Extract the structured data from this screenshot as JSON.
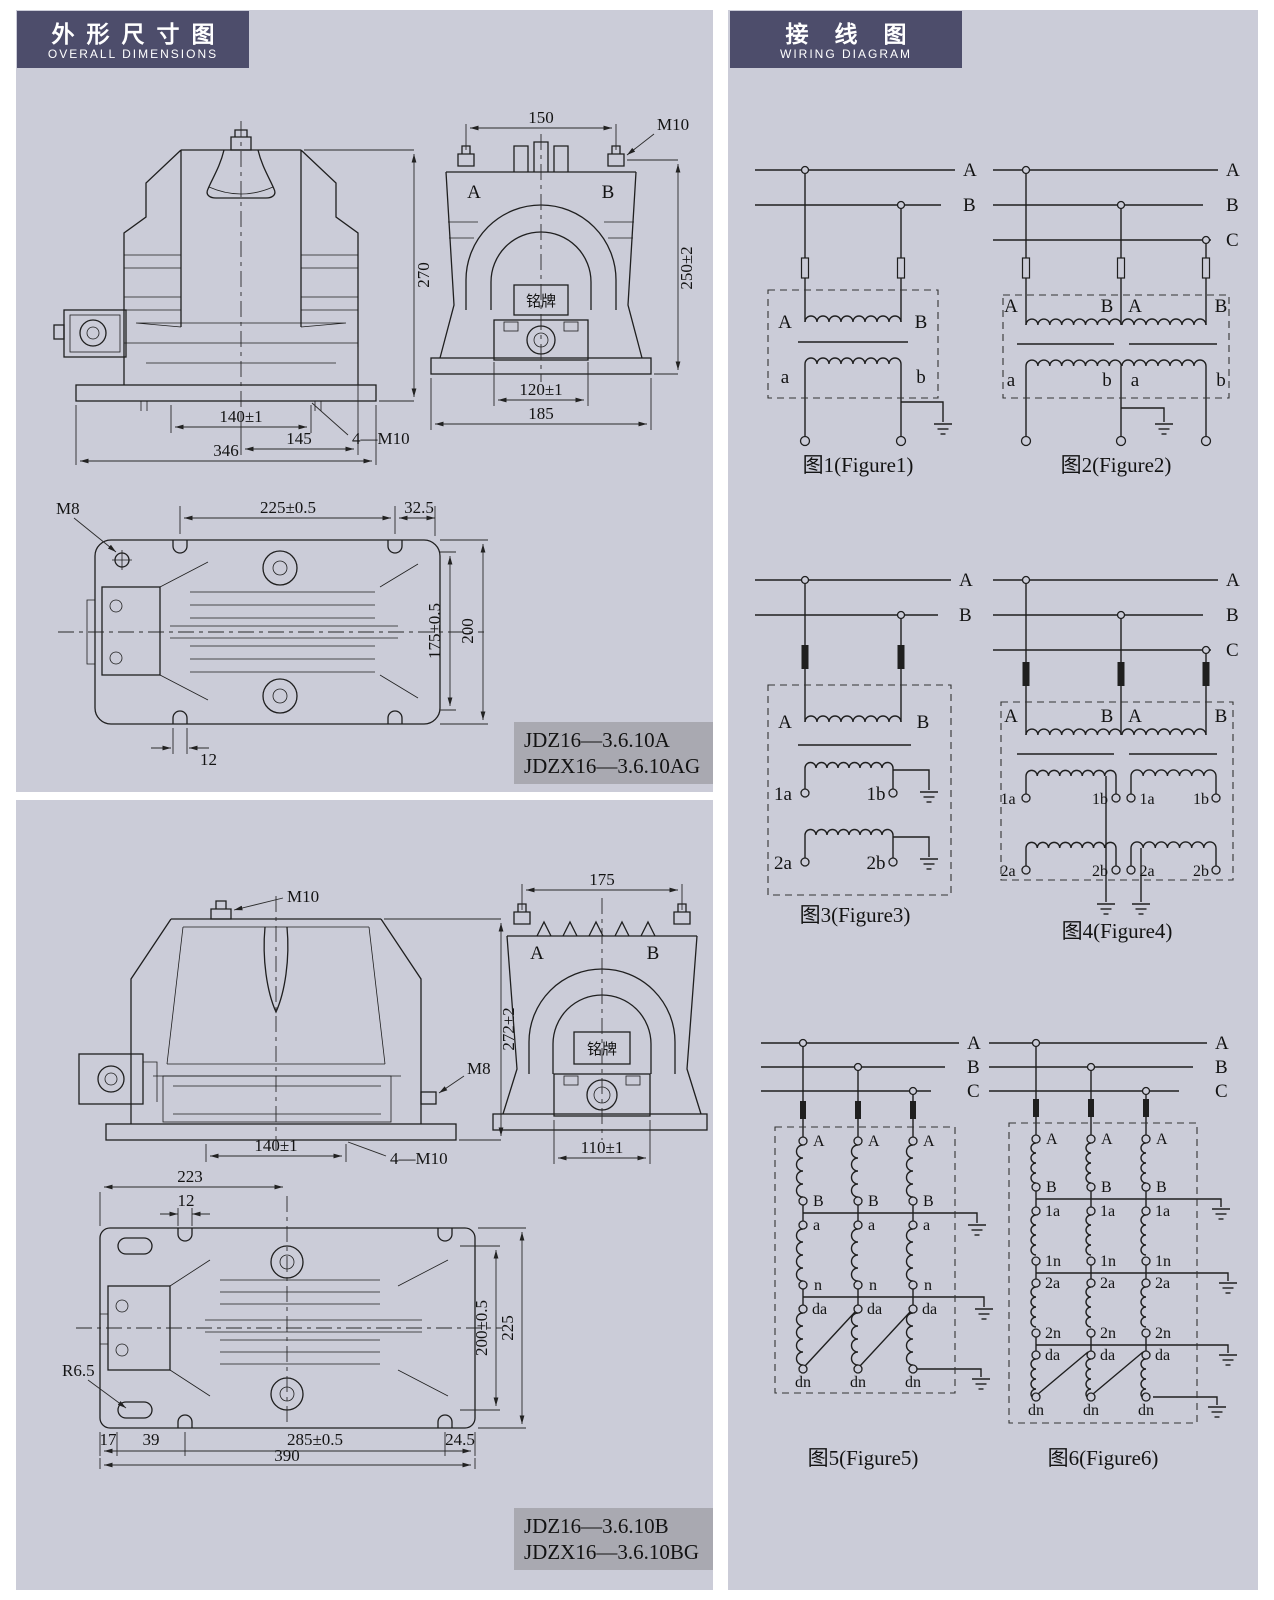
{
  "colors": {
    "panel_bg": "#cbccd8",
    "header_bg": "#4d4d6b",
    "model_box_bg": "#a9a9b1",
    "line": "#1f1f1f"
  },
  "headers": {
    "left": {
      "zh": "外形尺寸图",
      "en": "OVERALL DIMENSIONS"
    },
    "right": {
      "zh": "接线图",
      "en": "WIRING DIAGRAM"
    }
  },
  "models": {
    "a": {
      "line1": "JDZ16—3.6.10A",
      "line2": "JDZX16—3.6.10AG"
    },
    "b": {
      "line1": "JDZ16—3.6.10B",
      "line2": "JDZX16—3.6.10BG"
    }
  },
  "d": {
    "af": {
      "h270": "270",
      "w140": "140±1",
      "m10": "4—M10",
      "w145": "145",
      "w346": "346"
    },
    "as": {
      "w150": "150",
      "m10": "M10",
      "a": "A",
      "b": "B",
      "np": "铭牌",
      "h250": "250±2",
      "w120": "120±1",
      "w185": "185"
    },
    "at": {
      "m8": "M8",
      "w225": "225±0.5",
      "w325": "32.5",
      "h175": "175±0.5",
      "h200": "200",
      "w12": "12"
    },
    "bf": {
      "m10": "M10",
      "h272": "272±2",
      "m8": "M8",
      "w140": "140±1",
      "m104": "4—M10"
    },
    "bs": {
      "w175": "175",
      "a": "A",
      "b": "B",
      "np": "铭牌",
      "w110": "110±1"
    },
    "bt": {
      "w223": "223",
      "w12": "12",
      "r65": "R6.5",
      "d17": "17",
      "d39": "39",
      "d285": "285±0.5",
      "d245": "24.5",
      "d390": "390",
      "h200": "200±0.5",
      "h225": "225"
    }
  },
  "figs": {
    "f1": {
      "cap": "图1(Figure1)",
      "bus": [
        "A",
        "B"
      ],
      "p": [
        "A",
        "B"
      ],
      "s": [
        "a",
        "b"
      ]
    },
    "f2": {
      "cap": "图2(Figure2)",
      "bus": [
        "A",
        "B",
        "C"
      ],
      "p": [
        "A",
        "B"
      ],
      "s": [
        "a",
        "b"
      ]
    },
    "f3": {
      "cap": "图3(Figure3)",
      "bus": [
        "A",
        "B"
      ],
      "p": [
        "A",
        "B"
      ],
      "s1": [
        "1a",
        "1b"
      ],
      "s2": [
        "2a",
        "2b"
      ]
    },
    "f4": {
      "cap": "图4(Figure4)",
      "bus": [
        "A",
        "B",
        "C"
      ],
      "p": [
        "A",
        "B"
      ],
      "s1": [
        "1a",
        "1b"
      ],
      "s2": [
        "2a",
        "2b"
      ]
    },
    "f5": {
      "cap": "图5(Figure5)",
      "bus": [
        "A",
        "B",
        "C"
      ],
      "w": [
        "A",
        "B",
        "a",
        "n",
        "da",
        "dn"
      ]
    },
    "f6": {
      "cap": "图6(Figure6)",
      "bus": [
        "A",
        "B",
        "C"
      ],
      "w": [
        "A",
        "B",
        "1a",
        "1n",
        "2a",
        "2n",
        "da",
        "dn"
      ]
    }
  }
}
